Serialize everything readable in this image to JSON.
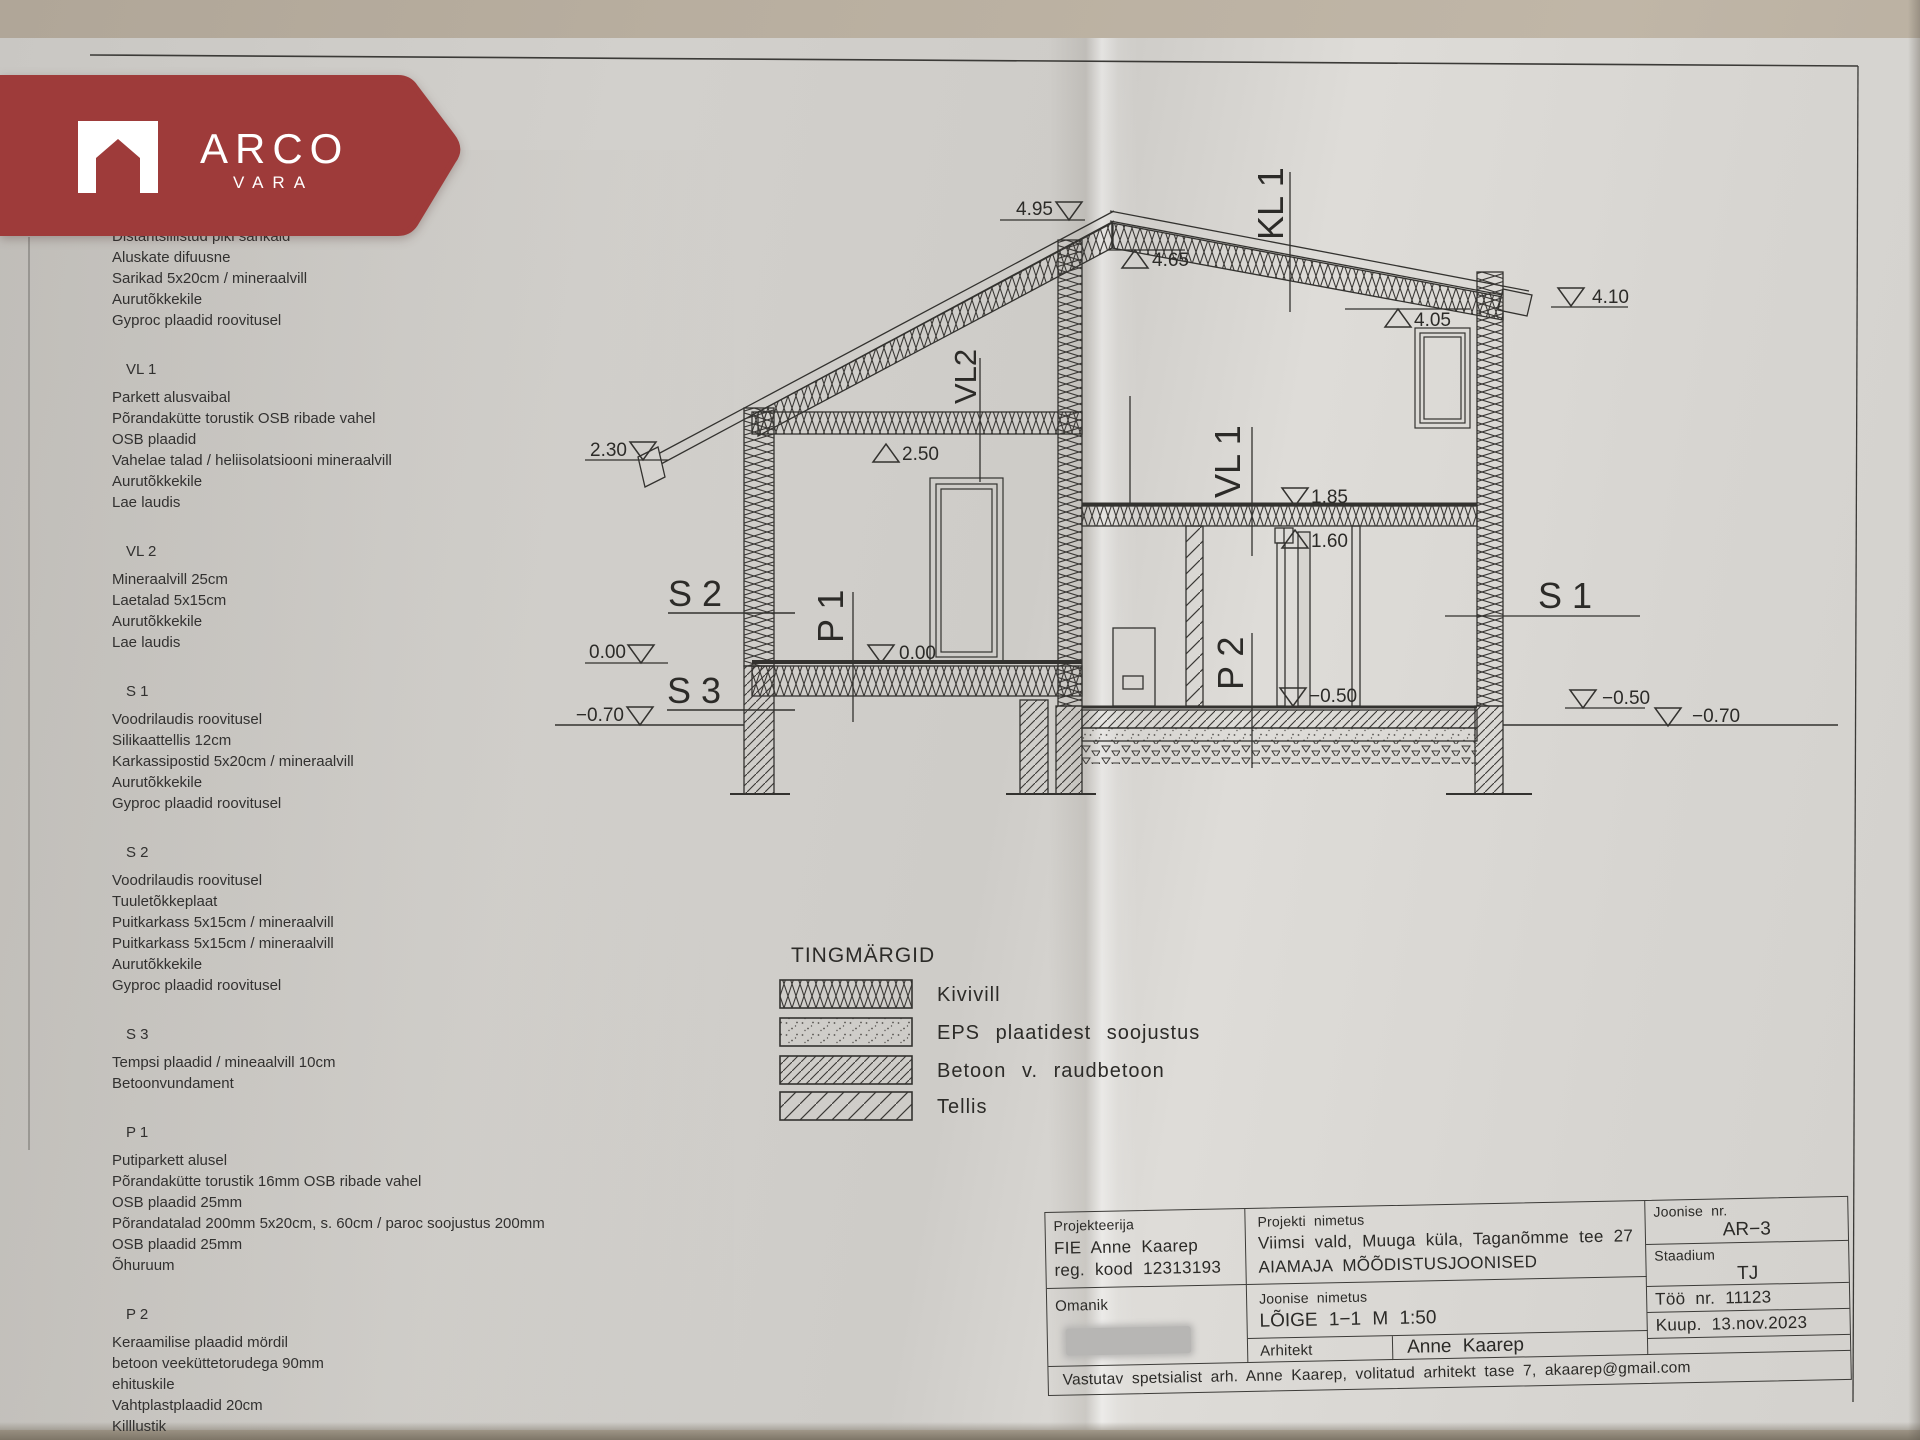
{
  "logo": {
    "brand": "ARCO",
    "sub": "VARA",
    "color": "#9e3b3a"
  },
  "specs": {
    "blocks": [
      {
        "title": "",
        "lines": [
          "Distantsiliistud piki sarikaid",
          "Aluskate difuusne",
          "Sarikad 5x20cm / mineraalvill",
          "Aurutõkkekile",
          "Gyproc plaadid roovitusel"
        ]
      },
      {
        "title": "VL 1",
        "lines": [
          "Parkett alusvaibal",
          "Põrandakütte torustik OSB ribade vahel",
          "OSB plaadid",
          "Vahelae talad / heliisolatsiooni mineraalvill",
          "Aurutõkkekile",
          "Lae laudis"
        ]
      },
      {
        "title": "VL 2",
        "lines": [
          "Mineraalvill 25cm",
          "Laetalad 5x15cm",
          "Aurutõkkekile",
          "Lae laudis"
        ]
      },
      {
        "title": "S 1",
        "lines": [
          "Voodrilaudis roovitusel",
          "Silikaattellis 12cm",
          "Karkassipostid 5x20cm / mineraalvill",
          "Aurutõkkekile",
          "Gyproc plaadid roovitusel"
        ]
      },
      {
        "title": "S 2",
        "lines": [
          "Voodrilaudis roovitusel",
          "Tuuletõkkeplaat",
          "Puitkarkass 5x15cm / mineraalvill",
          "Puitkarkass 5x15cm / mineraalvill",
          "Aurutõkkekile",
          "Gyproc plaadid roovitusel"
        ]
      },
      {
        "title": "S 3",
        "lines": [
          "Tempsi plaadid / mineaalvill 10cm",
          "Betoonvundament"
        ]
      },
      {
        "title": "P 1",
        "lines": [
          "Putiparkett  alusel",
          "Põrandakütte torustik 16mm OSB ribade vahel",
          "OSB plaadid 25mm",
          "Põrandatalad 200mm 5x20cm, s. 60cm / paroc soojustus 200mm",
          "OSB plaadid 25mm",
          "Õhuruum"
        ]
      },
      {
        "title": "P 2",
        "lines": [
          "Keraamilise plaadid mördil",
          "betoon veeküttetorudega 90mm",
          "ehituskile",
          "Vahtplastplaadid 20cm",
          "Killlustik"
        ]
      }
    ]
  },
  "drawing": {
    "labels": {
      "kl1": "KL 1",
      "vl2": "VL2",
      "vl1": "VL 1",
      "s1": "S 1",
      "s2": "S 2",
      "s3": "S 3",
      "p1": "P 1",
      "p2": "P 2"
    },
    "elevations": {
      "e495": "4.95",
      "e465": "4.65",
      "e410": "4.10",
      "e405": "4.05",
      "e250": "2.50",
      "e230": "2.30",
      "e185": "1.85",
      "e160": "1.60",
      "e000l": "0.00",
      "e000i": "0.00",
      "em050i": "−0.50",
      "em050r": "−0.50",
      "em070l": "−0.70",
      "em070r": "−0.70"
    }
  },
  "legend": {
    "title": "TINGMÄRGID",
    "items": [
      {
        "label": "Kivivill"
      },
      {
        "label": "EPS plaatidest soojustus"
      },
      {
        "label": "Betoon v. raudbetoon"
      },
      {
        "label": "Tellis"
      }
    ]
  },
  "titleblock": {
    "projekteerija_label": "Projekteerija",
    "projekteerija_line1": "FIE Anne Kaarep",
    "projekteerija_line2": "reg. kood 12313193",
    "omanik_label": "Omanik",
    "projekti_nimetus_label": "Projekti nimetus",
    "projekti_line1": "Viimsi vald, Muuga küla, Taganõmme tee 27",
    "projekti_line2": "AIAMAJA MÕÕDISTUSJOONISED",
    "joonise_nimetus_label": "Joonise nimetus",
    "joonise_nimetus_value": "LÕIGE 1−1   M 1:50",
    "arhitekt_label": "Arhitekt",
    "arhitekt_value": "Anne Kaarep",
    "joonise_nr_label": "Joonise nr.",
    "joonise_nr_value": "AR−3",
    "staadium_label": "Staadium",
    "staadium_value": "TJ",
    "too_nr": "Töö nr.  11123",
    "kuup": "Kuup.  13.nov.2023",
    "vastutav": "Vastutav spetsialist arh. Anne Kaarep, volitatud arhitekt tase 7, akaarep@gmail.com"
  }
}
